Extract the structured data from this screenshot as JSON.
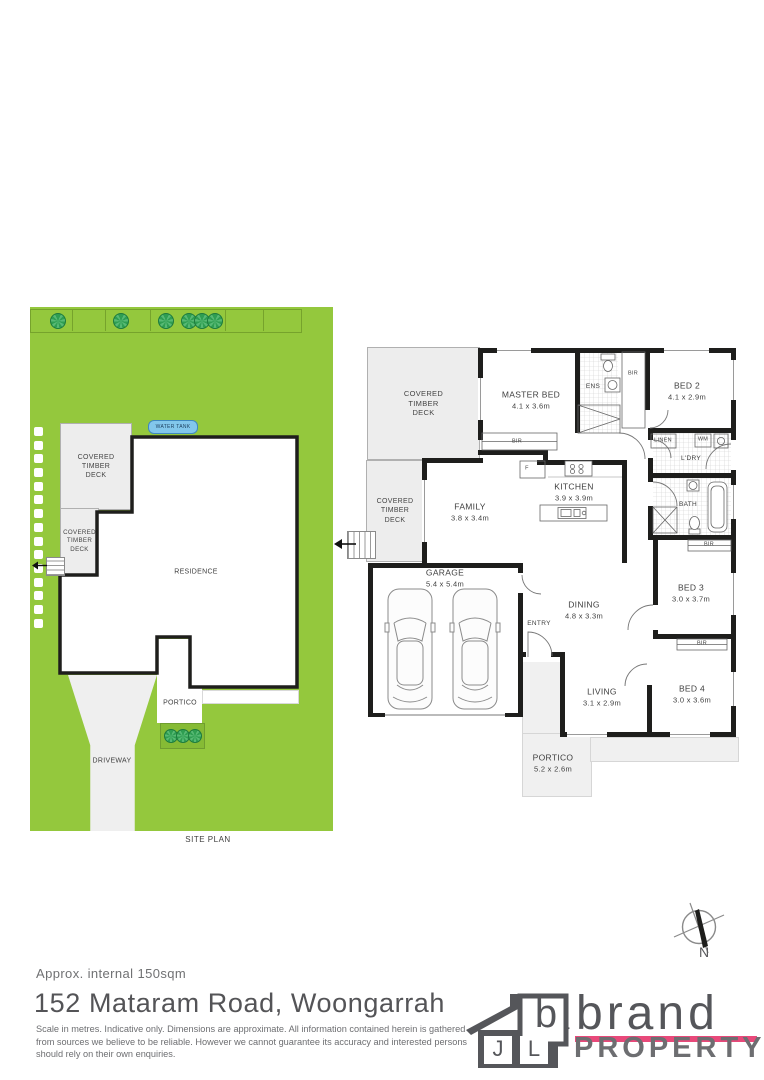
{
  "site_plan": {
    "caption": "SITE PLAN",
    "water_tank": "WATER TANK",
    "residence": "RESIDENCE",
    "portico": "PORTICO",
    "driveway": "DRIVEWAY",
    "deck": "COVERED TIMBER DECK"
  },
  "floor_plan": {
    "deck": "COVERED TIMBER DECK",
    "master_bed": {
      "label": "MASTER BED",
      "dims": "4.1 x 3.6m"
    },
    "bed2": {
      "label": "BED 2",
      "dims": "4.1 x 2.9m"
    },
    "bed3": {
      "label": "BED 3",
      "dims": "3.0 x 3.7m"
    },
    "bed4": {
      "label": "BED 4",
      "dims": "3.0 x 3.6m"
    },
    "kitchen": {
      "label": "KITCHEN",
      "dims": "3.9 x 3.9m"
    },
    "family": {
      "label": "FAMILY",
      "dims": "3.8 x 3.4m"
    },
    "dining": {
      "label": "DINING",
      "dims": "4.8 x 3.3m"
    },
    "living": {
      "label": "LIVING",
      "dims": "3.1 x 2.9m"
    },
    "garage": {
      "label": "GARAGE",
      "dims": "5.4 x 5.4m"
    },
    "portico": {
      "label": "PORTICO",
      "dims": "5.2 x 2.6m"
    },
    "ens": "ENS",
    "bath": "BATH",
    "ldry": "L'DRY",
    "linen": "LINEN",
    "wm": "WM",
    "bir": "BIR",
    "entry": "ENTRY",
    "fridge": "F"
  },
  "compass": {
    "north": "N"
  },
  "footer": {
    "area_note": "Approx. internal 150sqm",
    "address": "152 Mataram Road, Woongarrah",
    "disclaimer": "Scale in metres. Indicative only. Dimensions are approximate. All information contained herein is gathered from sources we believe to be reliable. However we cannot guarantee its accuracy and interested persons should rely on their own enquiries."
  },
  "logo": {
    "letter_j": "J",
    "letter_l": "L",
    "letter_b": "b",
    "brand": "brand",
    "property": "PROPERTY"
  },
  "colors": {
    "grass": "#94c83d",
    "tree": "#2f9e52",
    "wall": "#1e1e1c",
    "deck_fill": "#ededed",
    "water_tank_fill": "#82c7ec",
    "logo_grey": "#55565a",
    "property_grey": "#6d6e71",
    "accent_pink": "#e8497a"
  }
}
